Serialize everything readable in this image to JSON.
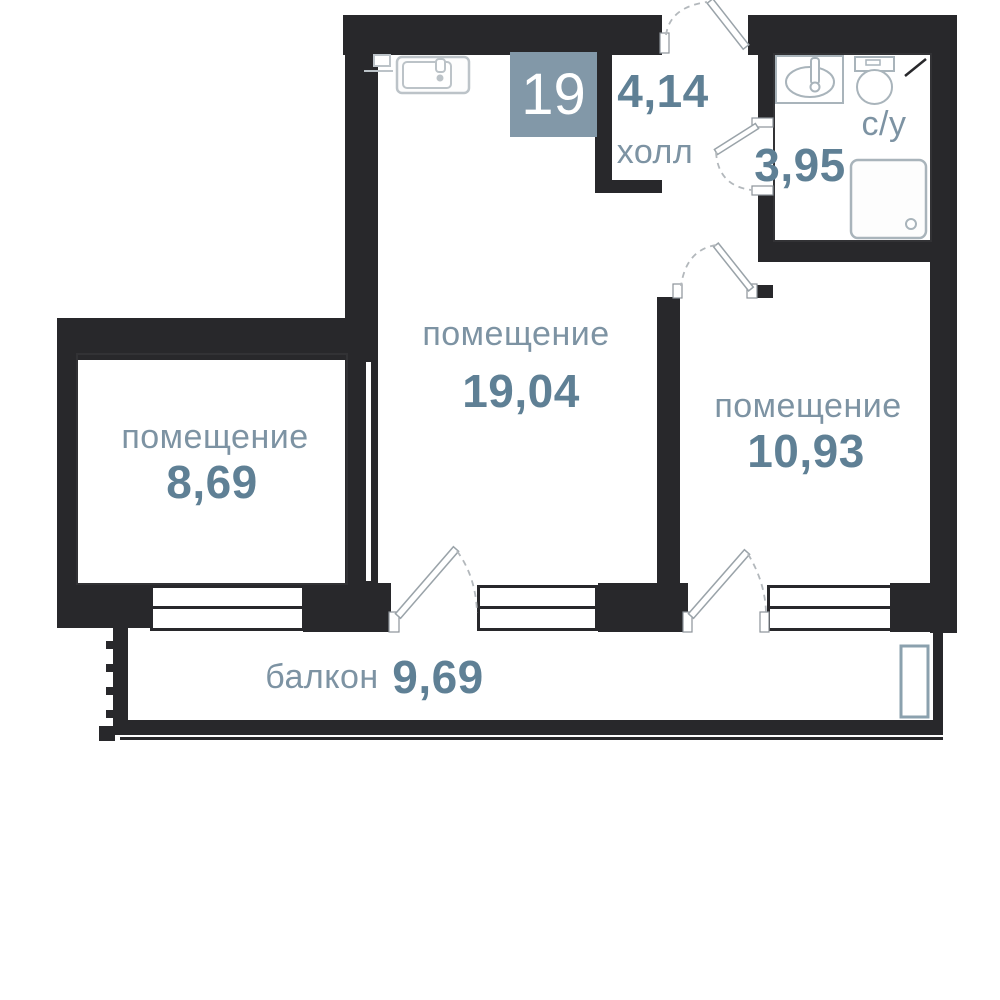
{
  "unit": {
    "number": "19"
  },
  "rooms": [
    {
      "id": "hall",
      "name": "холл",
      "area": "4,14"
    },
    {
      "id": "bathroom",
      "name": "с/у",
      "area": "3,95"
    },
    {
      "id": "room-main",
      "name": "помещение",
      "area": "19,04"
    },
    {
      "id": "room-right",
      "name": "помещение",
      "area": "10,93"
    },
    {
      "id": "room-left",
      "name": "помещение",
      "area": "8,69"
    },
    {
      "id": "balcony",
      "name": "балкон",
      "area": "9,69"
    }
  ],
  "colors": {
    "wall": "#28282b",
    "room_label": "#7d93a3",
    "area_number": "#5f8095",
    "unit_badge_bg": "#8298a8",
    "unit_badge_text": "#ffffff",
    "fixture_outline": "#a9b4bb",
    "door_outline": "#9aa3a9",
    "balcony_unit_outline": "#8ba1ae"
  }
}
